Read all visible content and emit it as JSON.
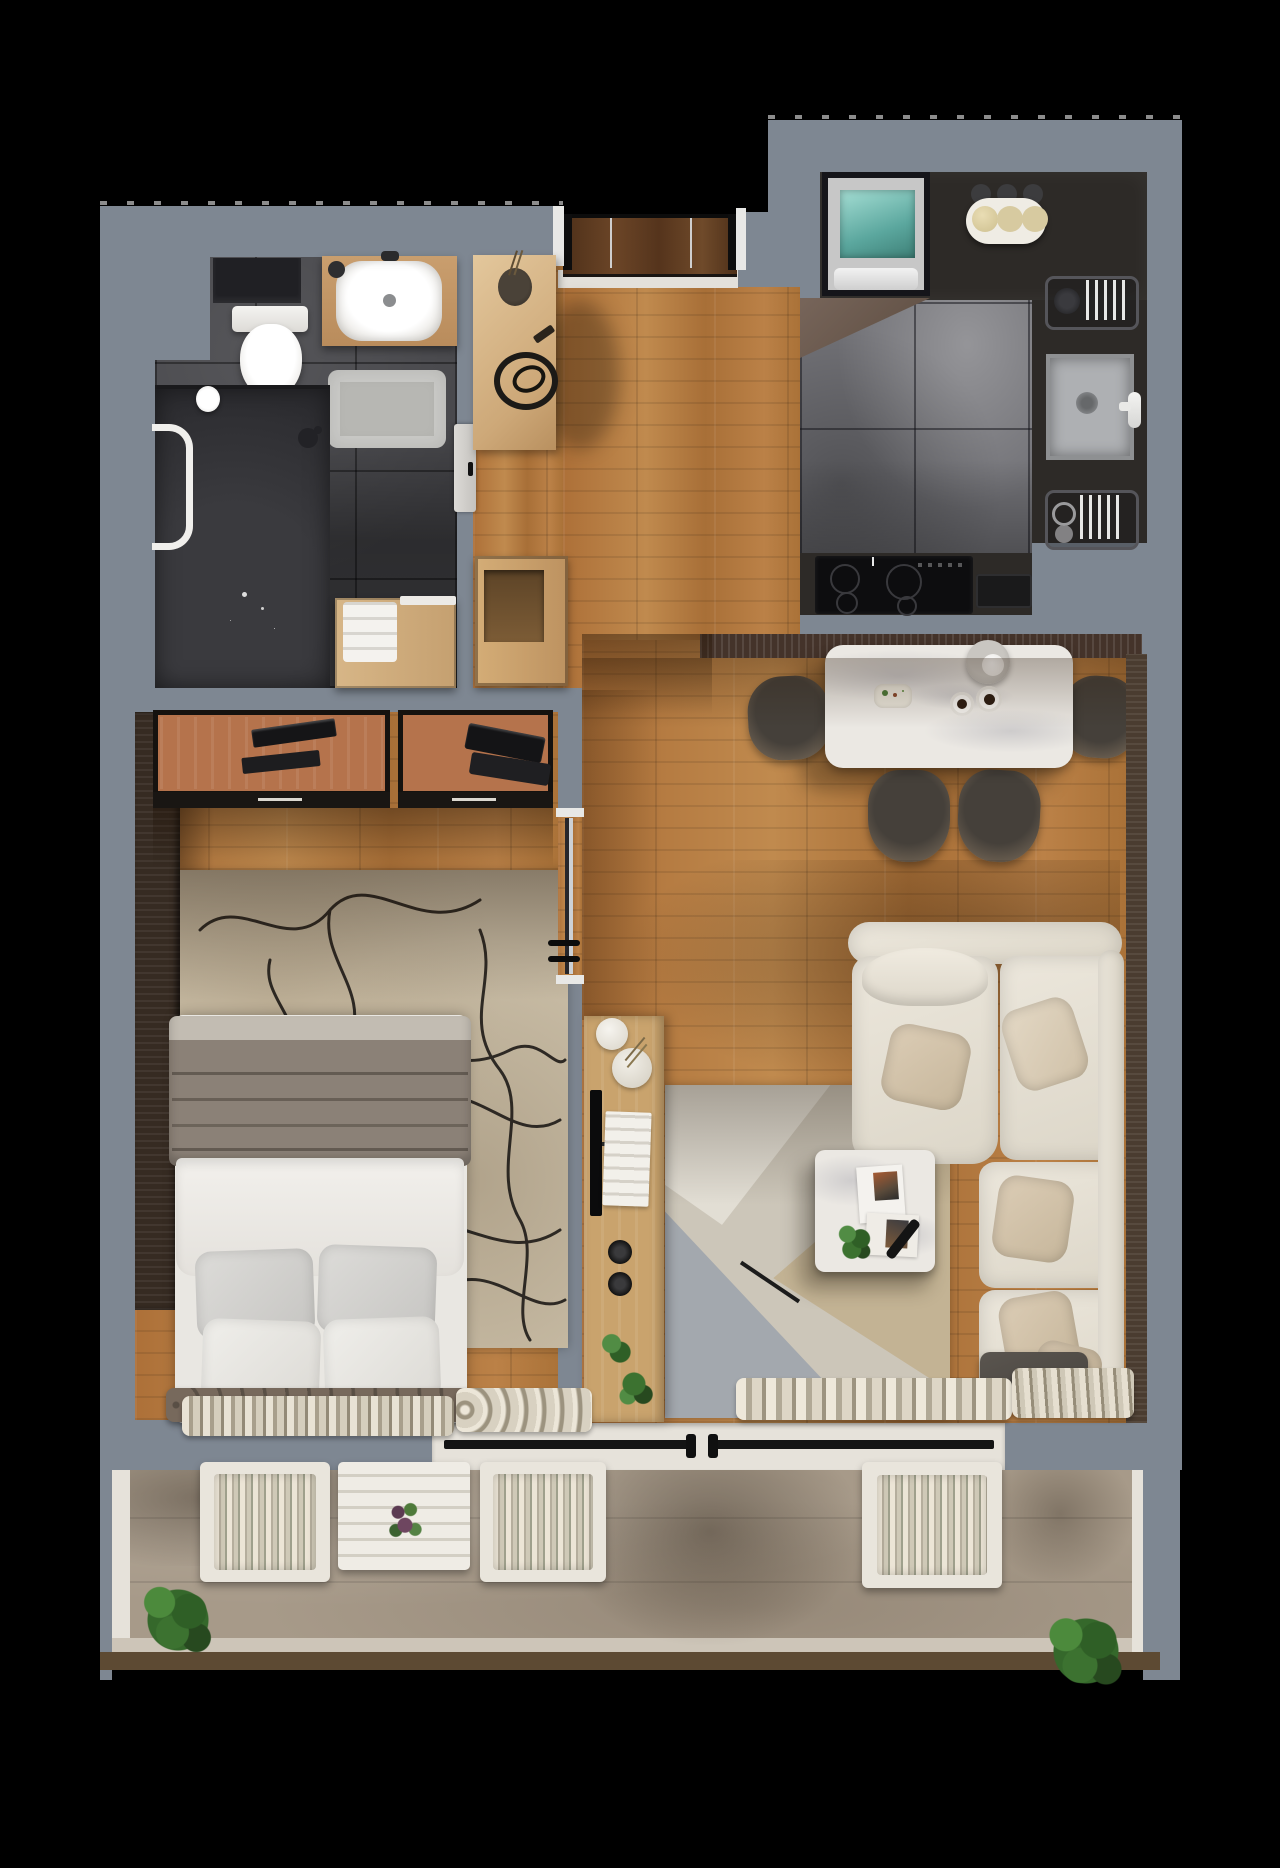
{
  "scene": {
    "title": "apartment-floor-plan-3d-top-view-render",
    "canvas": {
      "width": 1280,
      "height": 1868
    },
    "background_color": "#000000",
    "visible_text": []
  },
  "palette": {
    "wall_grey": "#7e8792",
    "wall_white": "#e6e2da",
    "wood_floor": "#b27c42",
    "bathroom_tile": "#47474b",
    "kitchen_marble_tile": "#717176",
    "balcony_concrete": "#a79a89",
    "kitchen_counter": "#2d2a27",
    "fridge_glass_teal": "#8fd0c6",
    "dining_table_marble": "#ebe8e3",
    "sofa_cream": "#e7e2d7",
    "pillow_beige": "#cfc0a9",
    "curtain_cream": "#ddd6c7",
    "bedroom_rug": "#c9bda6",
    "living_rug_grey": "#9fa3a9",
    "living_rug_beige": "#c3b394",
    "desk_wood": "#b5734c",
    "entrance_door_wood": "#5a3a23",
    "radiator_brown": "#4a3c30",
    "plant_green": "#3c7230",
    "ottoman_grey": "#514c46"
  },
  "rooms": {
    "bathroom": {
      "floor": "dark-grey-tile",
      "items": [
        "wall-niche",
        "toilet",
        "vanity-with-sink",
        "faucet",
        "soap-dispenser",
        "bath-mat",
        "shower-area",
        "shower-head",
        "towel-rail",
        "toilet-paper-holder",
        "laundry-cabinet",
        "towel-stack",
        "bathroom-door"
      ]
    },
    "hallway": {
      "floor": "oak-plank",
      "items": [
        "entrance-door",
        "door-threshold",
        "entry-console",
        "decor-vase",
        "decor-tray",
        "shoe-cabinet"
      ]
    },
    "kitchen": {
      "floor": "grey-marble-tile",
      "items": [
        "fridge",
        "three-bulb-lamp",
        "pot-lids",
        "dish-rack-upper",
        "sink",
        "faucet",
        "dish-rack-lower",
        "induction-cooktop",
        "cutting-board",
        "u-shaped-counter"
      ]
    },
    "dining": {
      "floor": "oak-plank",
      "items": [
        "trench-radiator",
        "marble-dining-table",
        "pendant-lamp",
        "teapot",
        "coffee-cup",
        "coffee-cup",
        "breakfast-plate",
        "dining-chair",
        "dining-chair",
        "dining-chair",
        "dining-chair"
      ]
    },
    "living": {
      "floor": "oak-plank",
      "items": [
        "sectional-sofa",
        "back-bolster",
        "throw-pillow",
        "throw-pillow",
        "throw-pillow",
        "throw-pillow",
        "throw-pillow",
        "ottoman",
        "geometric-area-rug",
        "coffee-table",
        "magazines",
        "remote-control",
        "potted-plant",
        "tv",
        "tv-console",
        "ball-vases",
        "book-stack",
        "speakers",
        "console-plants",
        "wall-radiator",
        "curtains",
        "balcony-doors"
      ]
    },
    "bedroom": {
      "floor": "oak-plank",
      "items": [
        "wardrobe",
        "desk",
        "desk",
        "monitor",
        "keyboard",
        "laptop",
        "abstract-rug",
        "double-bed",
        "grey-blanket",
        "white-duvet",
        "pillow",
        "pillow",
        "pillow",
        "pillow",
        "headboard",
        "sliding-glass-door",
        "curtains",
        "rolled-blankets"
      ]
    },
    "balcony": {
      "floor": "concrete",
      "items": [
        "lounge-chair",
        "slatted-table",
        "flower-pot",
        "lounge-chair",
        "lounge-chair",
        "shrub",
        "shrub"
      ]
    }
  }
}
